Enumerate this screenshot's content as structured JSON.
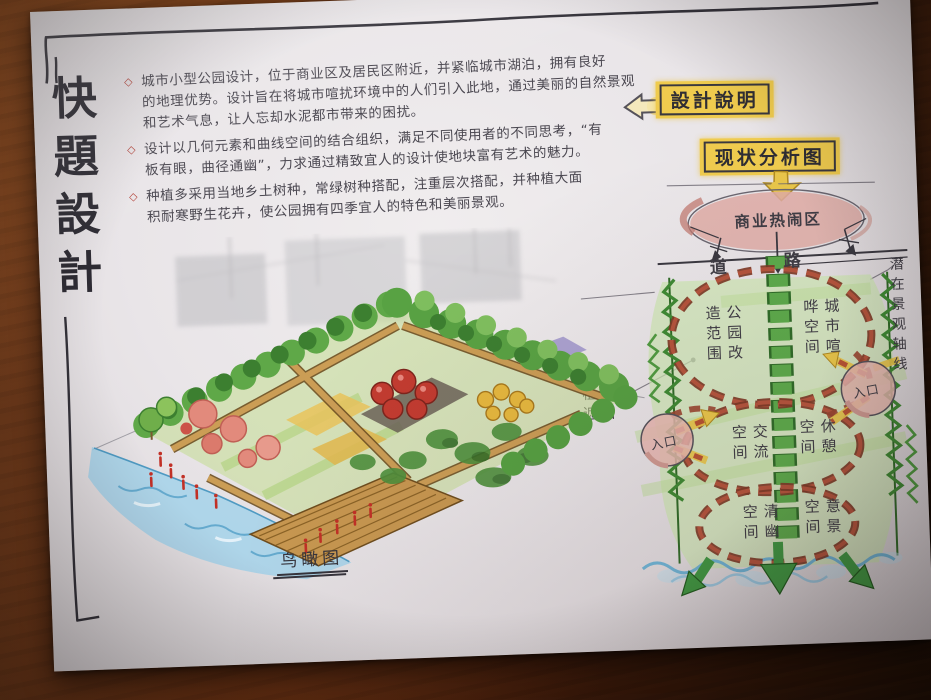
{
  "board": {
    "vertical_title": "快題設計",
    "perspective_caption": "鸟瞰图"
  },
  "notes": {
    "bullet_symbol": "◇",
    "items": [
      {
        "lines": [
          "城市小型公园设计，位于商业区及居民区附近，并紧临城市湖泊，拥有良好",
          "的地理优势。设计旨在将城市喧扰环境中的人们引入此地，通过美丽的自然景观",
          "和艺术气息，让人忘却水泥都市带来的困扰。"
        ]
      },
      {
        "lines": [
          "设计以几何元素和曲线空间的结合组织，满足不同使用者的不同思考，“有",
          "板有眼，曲径通幽”，力求通过精致宜人的设计使地块富有艺术的魅力。"
        ]
      },
      {
        "lines": [
          "种植多采用当地乡土树种，常绿树种搭配，注重层次搭配，并种植大面",
          "积耐寒野生花卉，使公园拥有四季宜人的特色和美丽景观。"
        ]
      }
    ]
  },
  "callouts": {
    "design_note_label": "設計說明",
    "analysis_label": "现状分析图"
  },
  "analysis": {
    "top_zone": "商业热闹区",
    "road_left": "道",
    "road_right": "路",
    "zone1_left": "公园改造范围",
    "zone1_right": "城市喧哗空间",
    "zone2_left": "交流空间",
    "zone2_right": "休憩空间",
    "zone3_left": "清幽空间",
    "zone3_right": "意景空间",
    "entrance_left": "入口",
    "entrance_right": "入口",
    "plant_screen": "植物遮挡",
    "axis_note": "潜在景观轴线"
  },
  "palette": {
    "highlight_yellow": "#efcb4e",
    "zone_pink": "#dfaca6",
    "dash_red": "#9a4530",
    "axis_green": "#4f9f40",
    "wash_green": "#cfe7b4",
    "water_blue": "#6fb6d8",
    "ink": "#3a3840",
    "paper": "#e9e5e8"
  }
}
